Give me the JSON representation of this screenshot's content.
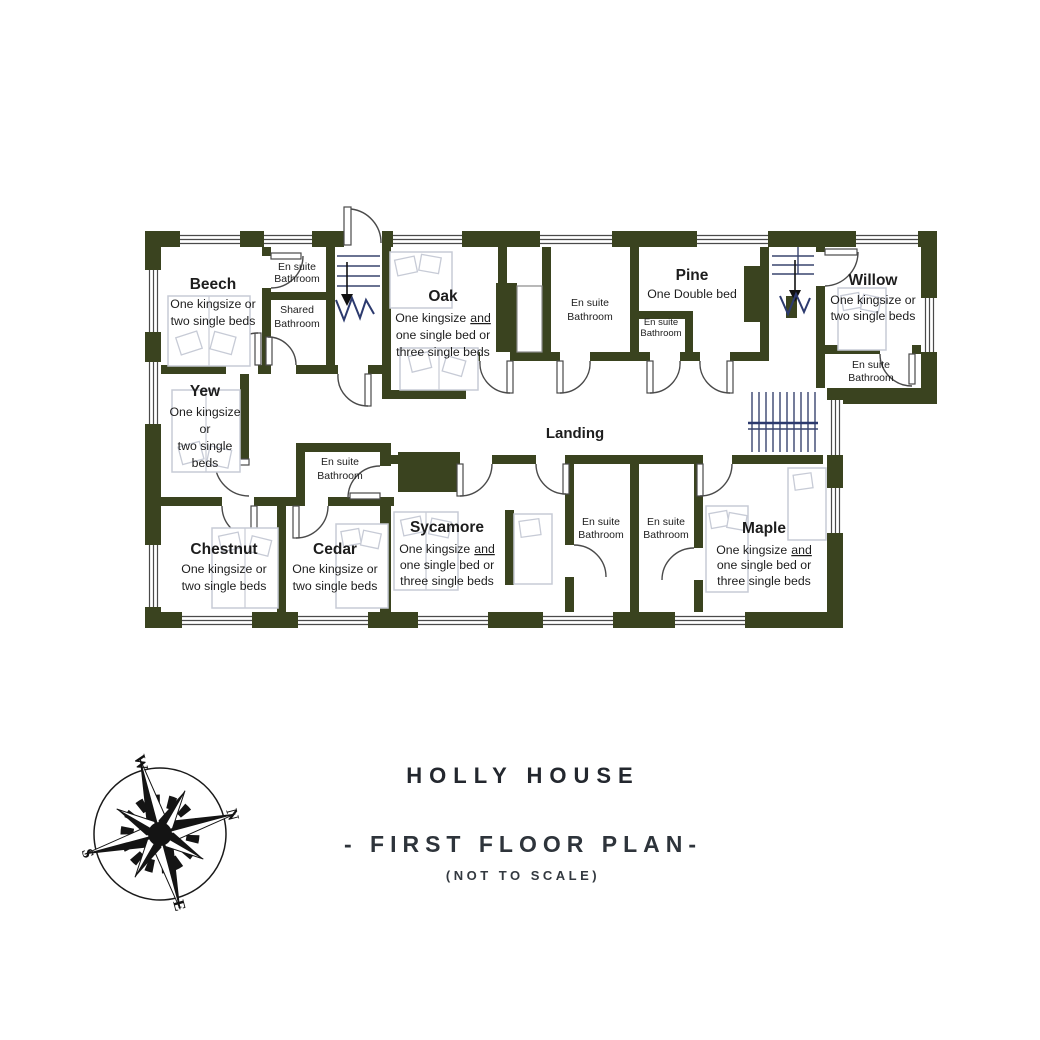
{
  "plan": {
    "landing": "Landing",
    "rooms": {
      "beech": {
        "name": "Beech",
        "l1": "One kingsize or",
        "l2": "two single beds"
      },
      "yew": {
        "name": "Yew",
        "l1": "One kingsize",
        "l2": "or",
        "l3": "two single",
        "l4": "beds"
      },
      "oak": {
        "name": "Oak",
        "l1a": "One kingsize",
        "l1b": "and",
        "l2": "one single bed or",
        "l3": "three single beds"
      },
      "pine": {
        "name": "Pine",
        "l1": "One Double bed"
      },
      "willow": {
        "name": "Willow",
        "l1": "One kingsize or",
        "l2": "two single beds"
      },
      "chestnut": {
        "name": "Chestnut",
        "l1": "One kingsize or",
        "l2": "two single beds"
      },
      "cedar": {
        "name": "Cedar",
        "l1": "One kingsize or",
        "l2": "two single beds"
      },
      "sycamore": {
        "name": "Sycamore",
        "l1a": "One kingsize",
        "l1b": "and",
        "l2": "one single bed or",
        "l3": "three single beds"
      },
      "maple": {
        "name": "Maple",
        "l1a": "One kingsize",
        "l1b": "and",
        "l2": "one single bed or",
        "l3": "three single beds"
      }
    },
    "bath": {
      "en1": "En suite",
      "en2": "Bathroom",
      "sh1": "Shared",
      "sh2": "Bathroom"
    }
  },
  "compass": {
    "n": "N",
    "e": "E",
    "s": "S",
    "w": "W"
  },
  "footer": {
    "title": "HOLLY HOUSE",
    "subtitle": "- FIRST FLOOR PLAN-",
    "note": "(NOT TO SCALE)"
  },
  "colors": {
    "wall": "#3a431f",
    "stairs": "#2c3a6e",
    "ink": "#1d1d1d",
    "bed_outline": "#c7cbd6"
  }
}
